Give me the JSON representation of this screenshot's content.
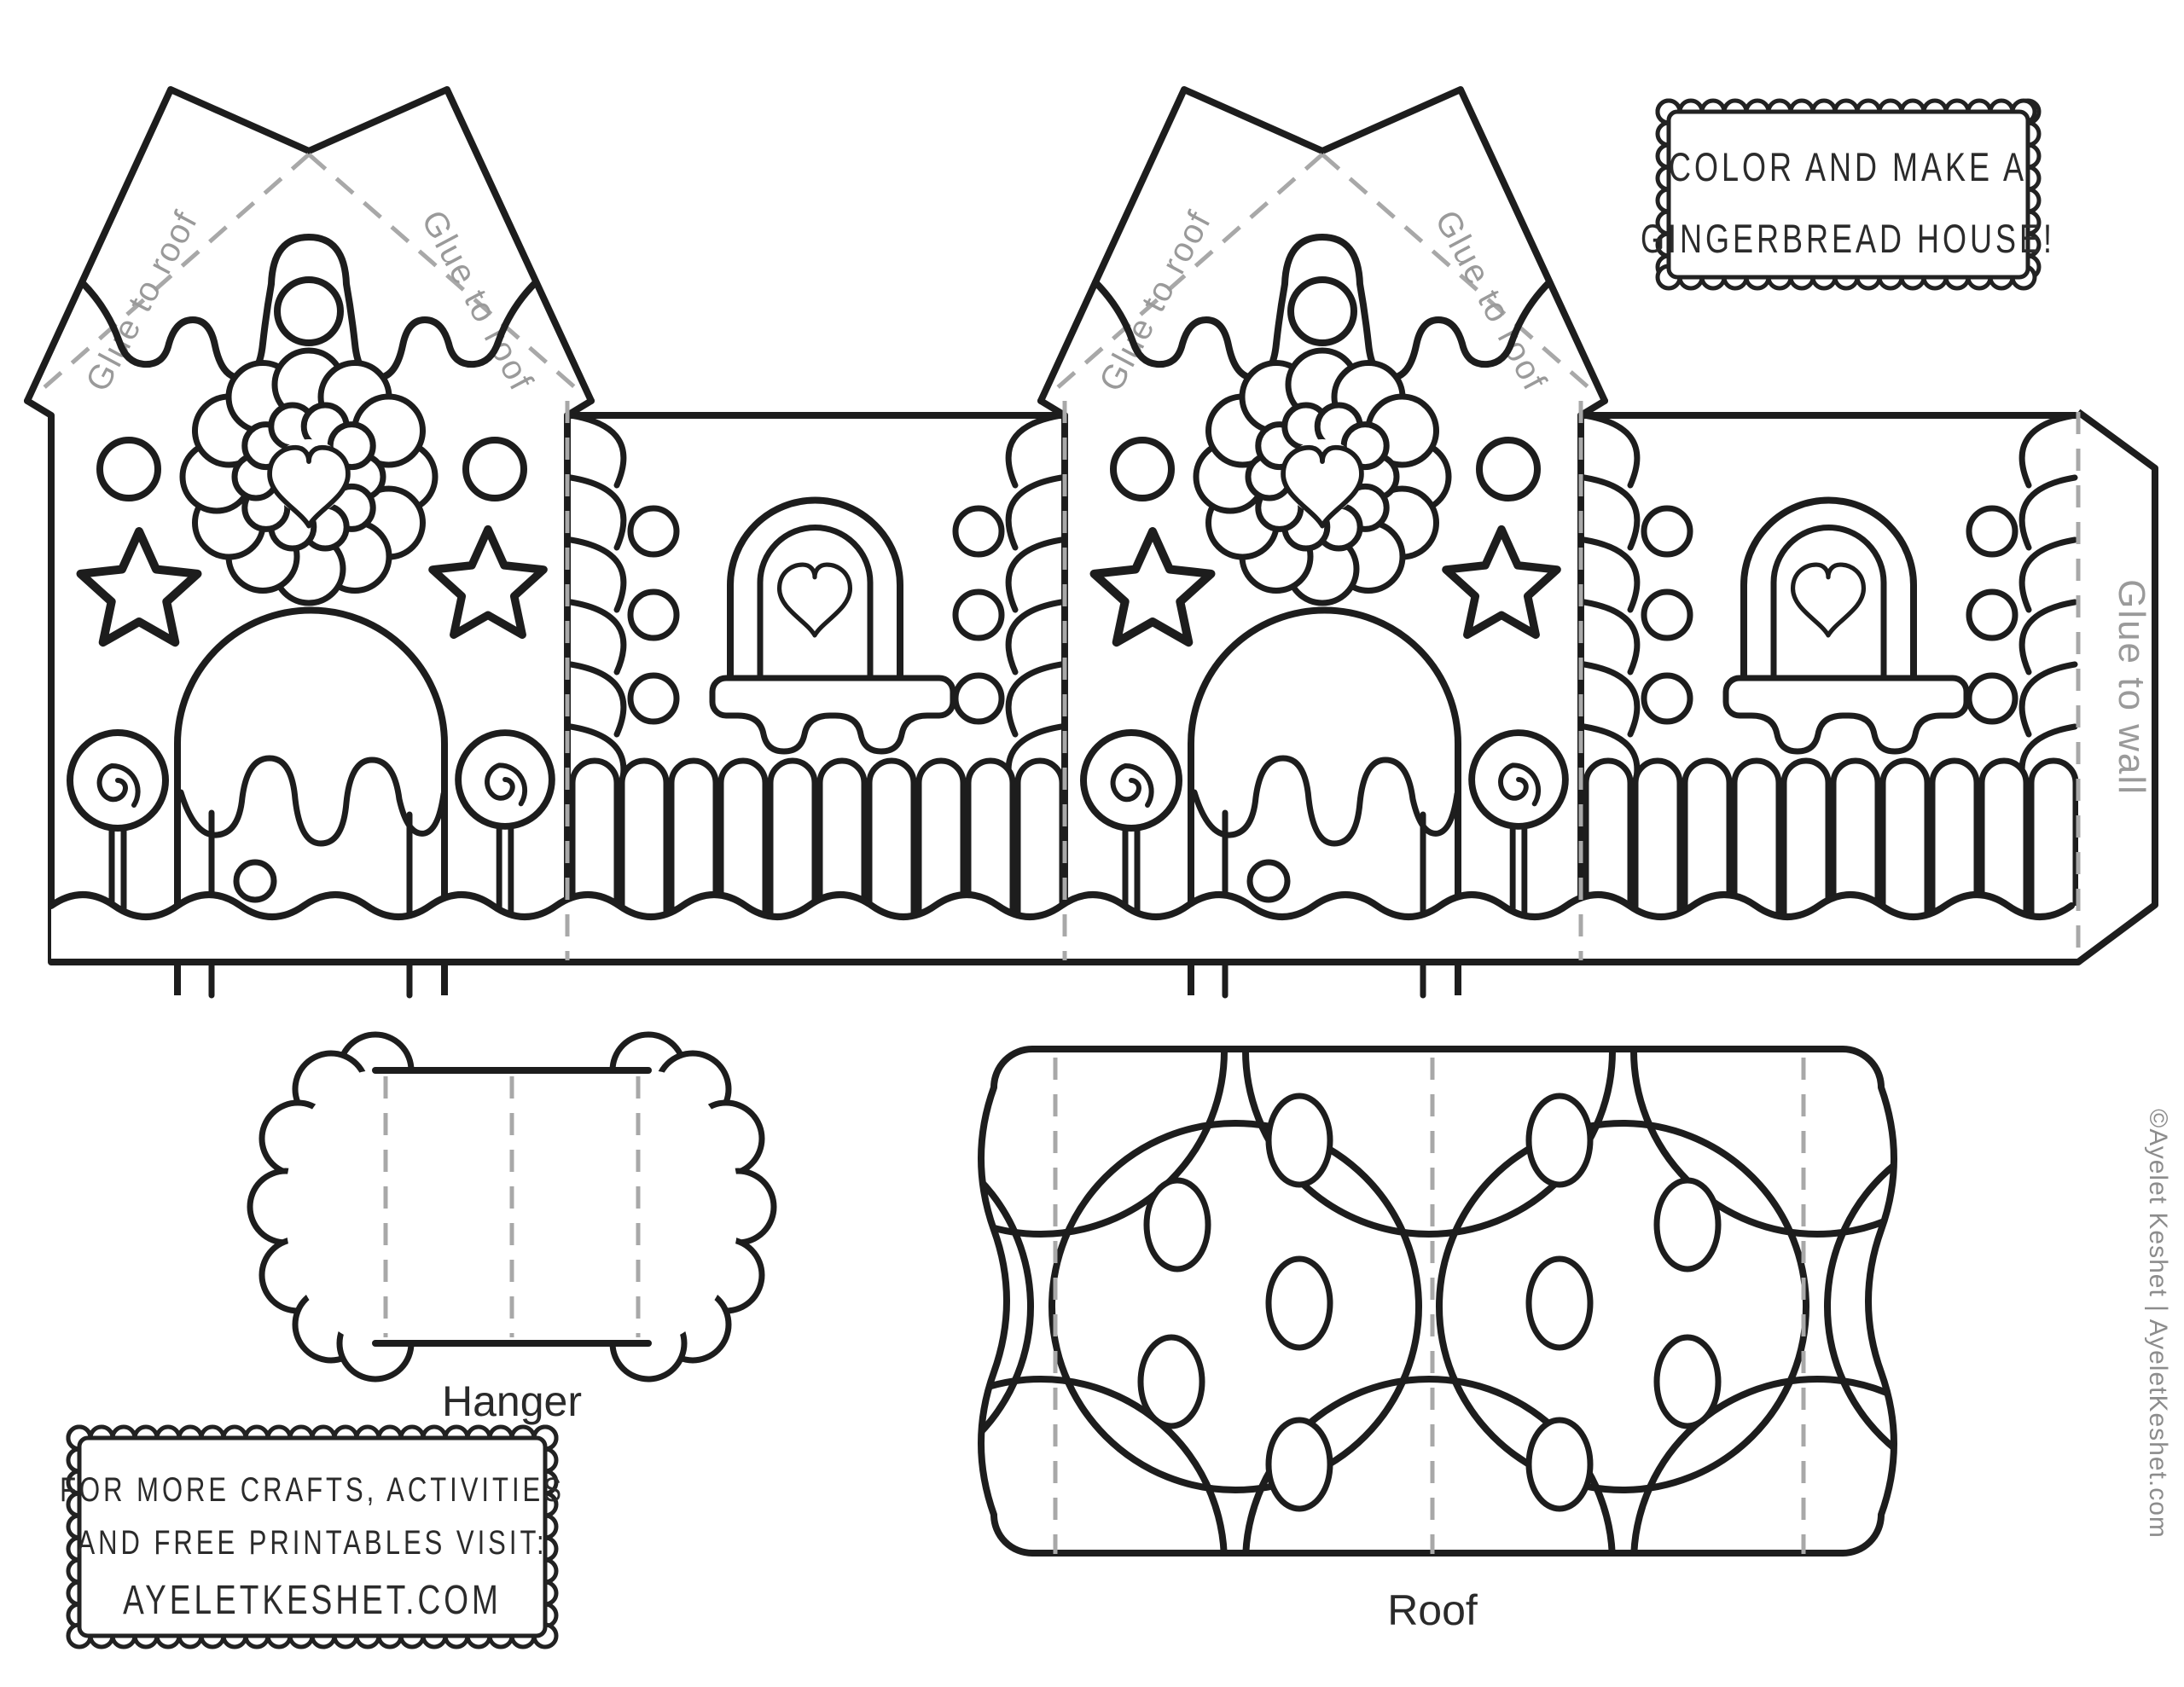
{
  "page": {
    "title": "Gingerbread house papercraft coloring template"
  },
  "banner": {
    "line1": "COLOR AND MAKE A",
    "line2": "GINGERBREAD HOUSE!"
  },
  "promo": {
    "line1": "FOR MORE CRAFTS, ACTIVITIES",
    "line2": "AND FREE PRINTABLES VISIT:",
    "line3": "AYELETKESHET.COM"
  },
  "labels": {
    "glue_roof": "Glue to roof",
    "glue_wall": "Glue to wall",
    "hanger": "Hanger",
    "roof": "Roof"
  },
  "credit": "©Ayelet Keshet | AyeletKeshet.com",
  "colors": {
    "line": "#1d1d1d",
    "fold_dash": "#a8a8a8",
    "glue_label": "#9a9a9a",
    "credit_gray": "#8c8c8c"
  }
}
